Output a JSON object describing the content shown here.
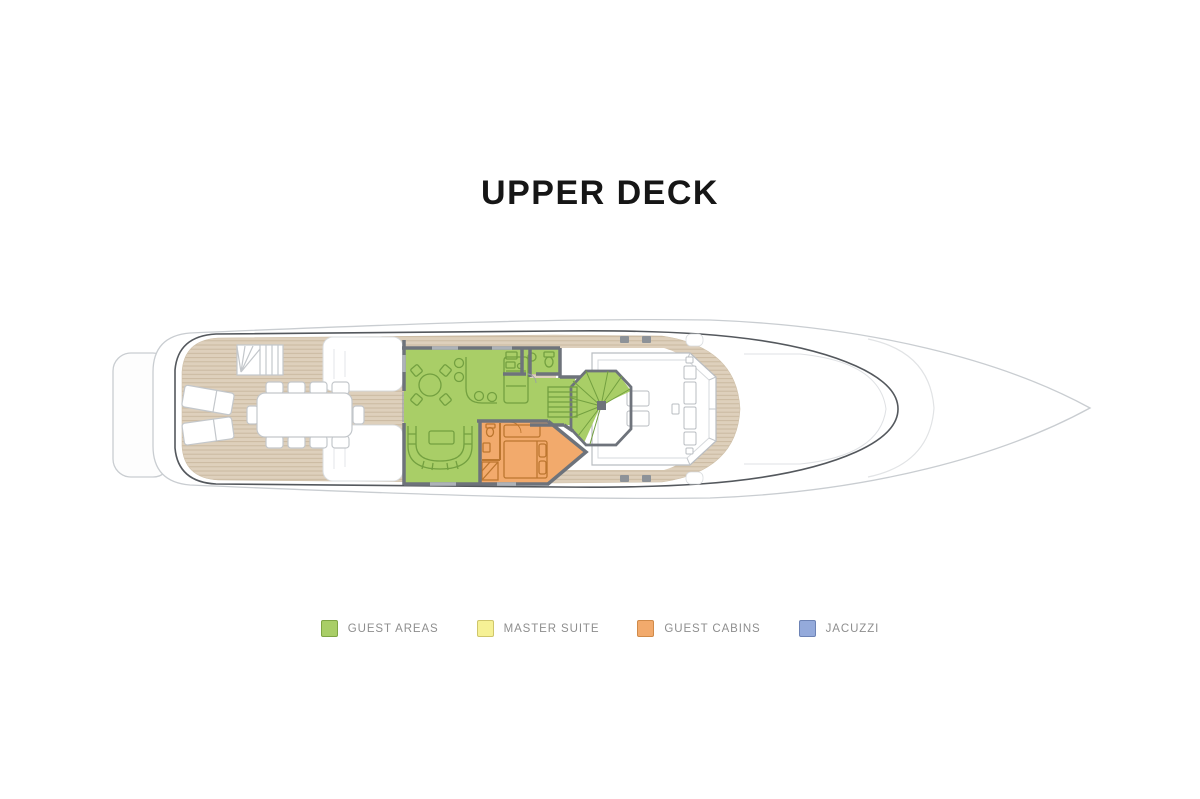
{
  "page": {
    "background": "#ffffff"
  },
  "title": "UPPER DECK",
  "legend": {
    "items": [
      {
        "label": "GUEST AREAS",
        "color": "#a9ce67",
        "border": "#7fa544"
      },
      {
        "label": "MASTER SUITE",
        "color": "#f6f195",
        "border": "#cfc66b"
      },
      {
        "label": "GUEST CABINS",
        "color": "#f2aa6c",
        "border": "#d08a49"
      },
      {
        "label": "JACUZZI",
        "color": "#94aadb",
        "border": "#6d83b5"
      }
    ]
  },
  "deck_plan": {
    "label": "Yacht upper deck floor plan, side profile pointing right",
    "colors": {
      "teak": "#ded0bc",
      "teak_line": "#c9b79e",
      "guest_area": "#a9ce67",
      "guest_area_line": "#73a040",
      "guest_cabin": "#f2aa6c",
      "guest_cabin_line": "#bc762f",
      "wall": "#6e737b",
      "hull_line": "#c9cdd1",
      "bulwark_line": "#54585d",
      "furniture_line": "#c3c7cb"
    },
    "features": [
      "swim-platform",
      "aft-staircase",
      "sun-loungers",
      "dining-table-10-seats",
      "sky-lounge-round-table",
      "bar-counter-with-stools",
      "tv-lounge-curved-sofa",
      "pantry",
      "day-head",
      "straight-staircase",
      "spiral-staircase",
      "guest-cabin-double-bed",
      "guest-cabin-bathroom",
      "wheelhouse-helm-console",
      "bow-walkway"
    ]
  }
}
